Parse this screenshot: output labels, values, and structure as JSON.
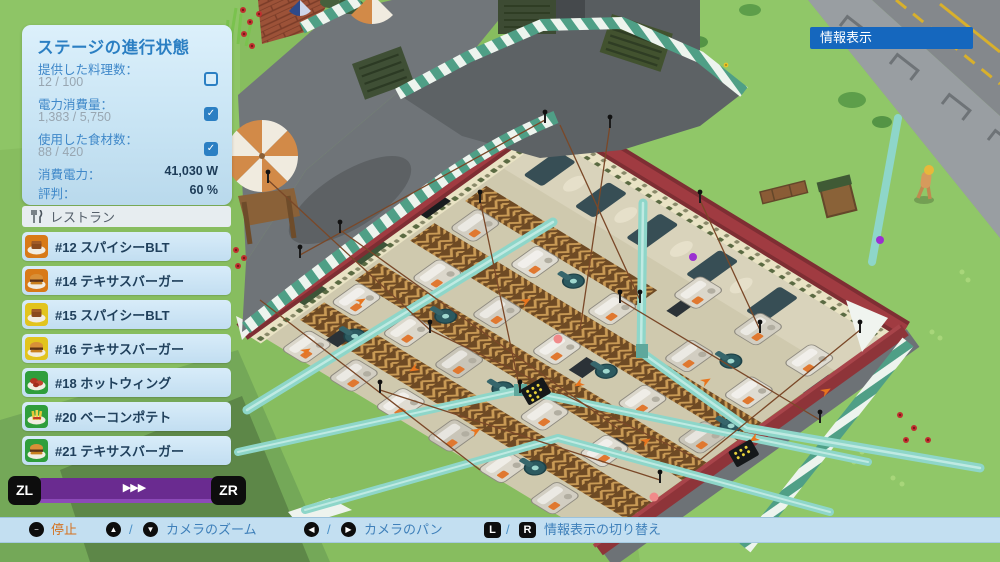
{
  "hud": {
    "progress_panel": {
      "title": "ステージの進行状態",
      "check_glyph": "✓",
      "rows": [
        {
          "label": "提供した料理数：",
          "value": "12 / 100",
          "checked": false
        },
        {
          "label": "電力消費量：",
          "value": "1,383 / 5,750",
          "checked": true
        },
        {
          "label": "使用した食材数：",
          "value": "88 / 420",
          "checked": true
        }
      ],
      "power": {
        "label": "消費電力：",
        "value": "41,030 W"
      },
      "reputation": {
        "label": "評判：",
        "value": "60 %"
      }
    },
    "restaurant_panel": {
      "header": "レストラン",
      "orders": [
        {
          "label": "#12 スパイシーBLT",
          "icon": "sandwich-icon",
          "color": "#d87a18"
        },
        {
          "label": "#14 テキサスバーガー",
          "icon": "burger-icon",
          "color": "#d87a18"
        },
        {
          "label": "#15 スパイシーBLT",
          "icon": "sandwich-icon",
          "color": "#e2c41e"
        },
        {
          "label": "#16 テキサスバーガー",
          "icon": "burger-icon",
          "color": "#e2c41e"
        },
        {
          "label": "#18 ホットウィング",
          "icon": "wings-icon",
          "color": "#2f9e3c"
        },
        {
          "label": "#20 ベーコンポテト",
          "icon": "fries-icon",
          "color": "#2f9e3c"
        },
        {
          "label": "#21 テキサスバーガー",
          "icon": "burger-icon",
          "color": "#2f9e3c"
        }
      ]
    },
    "speed_bar": {
      "zl": "ZL",
      "zr": "ZR",
      "speed": "▶▶▶"
    },
    "info_button": {
      "label": "情報表示"
    },
    "control_bar": {
      "stop": {
        "button": "−",
        "label": "停止"
      },
      "zoom": {
        "up": "▲",
        "sep": "/",
        "down": "▼",
        "label": "カメラのズーム"
      },
      "pan": {
        "left": "◀",
        "sep": "/",
        "right": "▶",
        "label": "カメラのパン"
      },
      "info": {
        "l": "L",
        "sep": "/",
        "r": "R",
        "label": "情報表示の切り替え"
      }
    },
    "colors": {
      "panel_blue": "#2b7fc3",
      "value_gray": "#98a6b1",
      "accent_purple": "#6a2b90",
      "info_button_blue": "#1567be",
      "stop_orange": "#d4711e",
      "bar_blue": "#c3dff1",
      "building_wall_red": "#a03b41",
      "awning_green": "#4f9f86",
      "pipe_teal": "#8ed6c9"
    }
  }
}
